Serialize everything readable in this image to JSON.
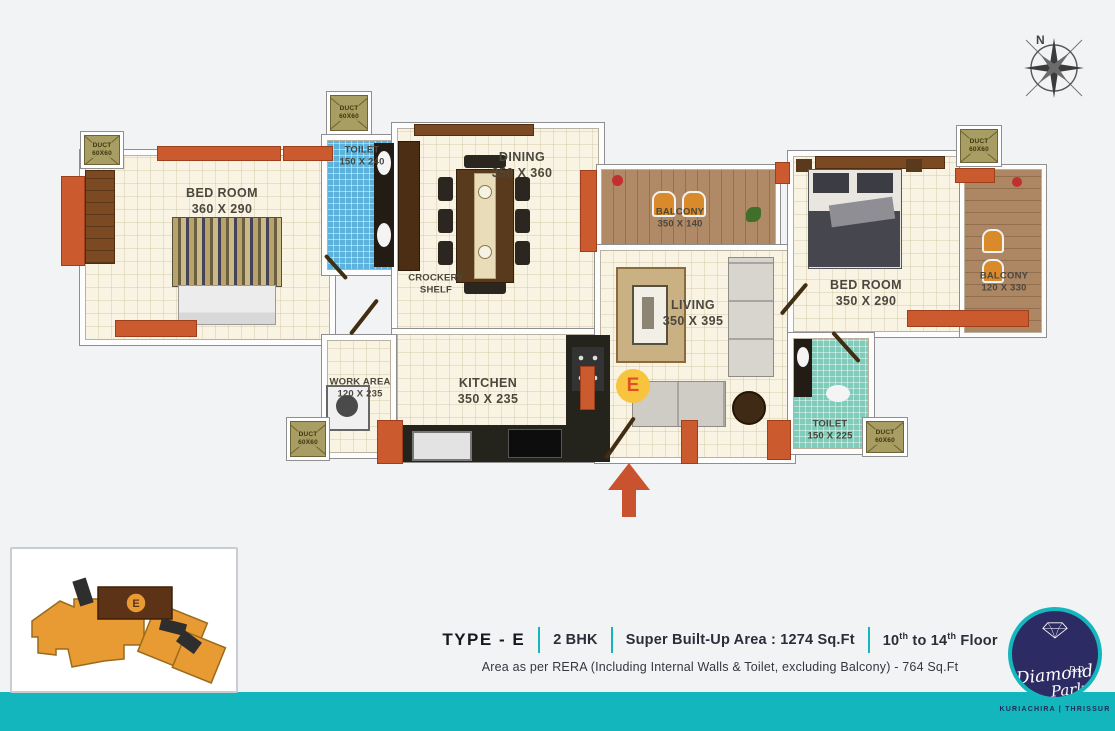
{
  "page": {
    "accent_teal": "#12b6bc",
    "accent_orange": "#cb5a2e",
    "background": "#f2f3f4"
  },
  "compass": {
    "label": "N"
  },
  "plan": {
    "unit_badge": "E",
    "duct": {
      "line1": "DUCT",
      "line2": "60X60"
    },
    "rooms": [
      {
        "id": "bedroom-1",
        "label": "BED ROOM",
        "dims": "360 X 290"
      },
      {
        "id": "toilet-1",
        "label": "TOILET",
        "dims": "150 X 240"
      },
      {
        "id": "dining",
        "label": "DINING",
        "dims": "350 X 360"
      },
      {
        "id": "crockery-shelf",
        "label": "CROCKERY SHELF",
        "dims": ""
      },
      {
        "id": "balcony-1",
        "label": "BALCONY",
        "dims": "350 X 140"
      },
      {
        "id": "living",
        "label": "LIVING",
        "dims": "350 X 395"
      },
      {
        "id": "bedroom-2",
        "label": "BED ROOM",
        "dims": "350 X 290"
      },
      {
        "id": "balcony-2",
        "label": "BALCONY",
        "dims": "120 X 330"
      },
      {
        "id": "work-area",
        "label": "WORK AREA",
        "dims": "120 X 235"
      },
      {
        "id": "kitchen",
        "label": "KITCHEN",
        "dims": "350 X 235"
      },
      {
        "id": "toilet-2",
        "label": "TOILET",
        "dims": "150 X 225"
      }
    ]
  },
  "keyplan": {
    "badge": "E"
  },
  "footer": {
    "type_label": "TYPE - E",
    "bhk": "2 BHK",
    "area": "Super Built-Up Area : 1274 Sq.Ft",
    "floor_from": "10",
    "floor_from_sup": "th",
    "floor_mid": "to",
    "floor_to": "14",
    "floor_to_sup": "th",
    "floor_end": "Floor",
    "rera": "Area as per RERA (Including Internal Walls & Toilet, excluding Balcony) - 764 Sq.Ft"
  },
  "logo": {
    "dd": "D.D",
    "name1": "Diamond",
    "name2": "Park",
    "location": "KURIACHIRA | THRISSUR"
  }
}
